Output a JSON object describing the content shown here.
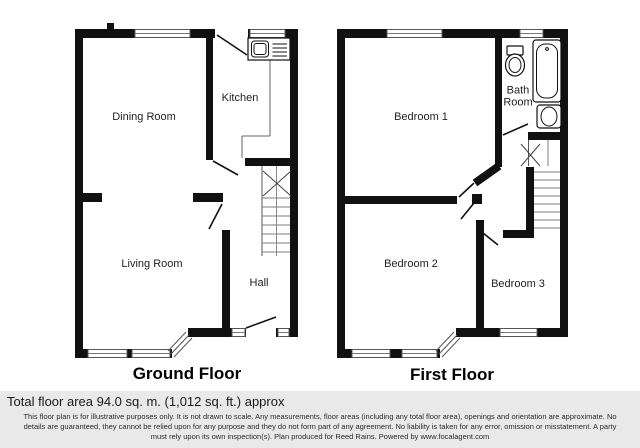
{
  "plans": {
    "ground_floor": {
      "title": "Ground Floor",
      "rooms": {
        "dining_room": "Dining Room",
        "kitchen": "Kitchen",
        "living_room": "Living Room",
        "hall": "Hall"
      },
      "features": [
        "kitchen-sink-icon",
        "staircase-icon",
        "bay-window-icon",
        "door-swing-icon",
        "window-icon"
      ]
    },
    "first_floor": {
      "title": "First Floor",
      "rooms": {
        "bedroom_1": "Bedroom 1",
        "bath_room_line_1": "Bath",
        "bath_room_line_2": "Room",
        "bedroom_2": "Bedroom 2",
        "bedroom_3": "Bedroom 3"
      },
      "features": [
        "toilet-icon",
        "bathtub-icon",
        "washbasin-icon",
        "staircase-icon",
        "bay-window-icon"
      ]
    }
  },
  "footer": {
    "total_area": "Total floor area 94.0 sq. m. (1,012 sq. ft.) approx",
    "disclaimer_line_1": "This floor plan is for illustrative purposes only. It is not drawn to scale. Any measurements, floor areas (including any total floor area), openings and orientation are approximate. No",
    "disclaimer_line_2": "details are guaranteed, they cannot be relied upon for any purpose and they do not form part of any agreement. No liability is taken for any error, omission or misstatement. A party",
    "disclaimer_line_3": "must rely upon its own inspection(s). Plan produced for Reed Rains. Powered by www.focalagent.com"
  },
  "colors": {
    "wall": "#111111",
    "thin_line": "#555555",
    "stair_line": "#7d7d7d",
    "footer_background": "#e9e9e9",
    "text": "#222222"
  }
}
